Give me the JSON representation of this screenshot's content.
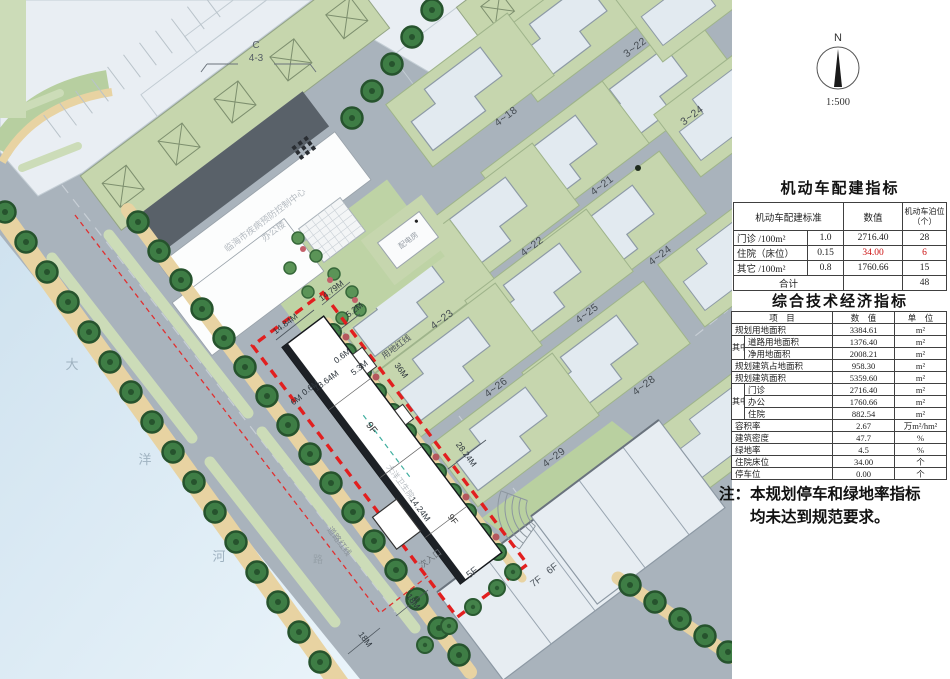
{
  "compass": {
    "north": "N",
    "scale": "1:500"
  },
  "map": {
    "labels": {
      "top_left_lot_l1": "C",
      "top_left_lot_l2": "4-3",
      "cdc_l1": "临海市疾病预防控制中心",
      "cdc_l2": "办公楼",
      "power_room": "配电房",
      "hospital_name": "大洋卫生院",
      "land_red_line": "用地红线",
      "road_red_line": "道路红线",
      "secondary_entrance": "次入口",
      "floors_9f": "9F",
      "floors_5f": "5F",
      "floors_7f": "7F",
      "floors_6f": "6F",
      "river_c1": "大",
      "river_c2": "洋",
      "river_c3": "河",
      "road_char": "路"
    },
    "lots": {
      "l3_22": "3~22",
      "l3_24": "3~24",
      "l4_18": "4~18",
      "l4_21": "4~21",
      "l4_22": "4~22",
      "l4_23": "4~23",
      "l4_24": "4~24",
      "l4_25": "4~25",
      "l4_26": "4~26",
      "l4_28": "4~28",
      "l4_29": "4~29"
    },
    "dims": {
      "d1": "14.84M",
      "d2": "14.79M",
      "d3": "5.2M",
      "d4": "0.6M",
      "d5": "5.3M",
      "d6": "36M",
      "d7": "13.64M",
      "d8": "0.6M",
      "d9": "6M",
      "d10": "28.24M",
      "d11": "14.24M",
      "d12": "18M",
      "d13": "18M"
    }
  },
  "tables": {
    "parking": {
      "title": "机动车配建指标",
      "head": {
        "standard": "机动车配建标准",
        "value": "数值",
        "berth_l1": "机动车泊位",
        "berth_l2": "（个）"
      },
      "rows": [
        {
          "name": "门诊 /100m²",
          "std": "1.0",
          "value": "2716.40",
          "berth": "28"
        },
        {
          "name": "住院（床位）",
          "std": "0.15",
          "value": "34.00",
          "berth": "6"
        },
        {
          "name": "其它 /100m²",
          "std": "0.8",
          "value": "1760.66",
          "berth": "15"
        },
        {
          "name": "合计",
          "std": "",
          "value": "",
          "berth": "48"
        }
      ]
    },
    "economic": {
      "title": "综合技术经济指标",
      "head": {
        "item": "项　目",
        "value": "数　值",
        "unit": "单　位"
      },
      "group_label": "其中",
      "rows": [
        {
          "item": "规划用地面积",
          "value": "3384.61",
          "unit": "m²"
        },
        {
          "item": "道路用地面积",
          "value": "1376.40",
          "unit": "m²"
        },
        {
          "item": "净用地面积",
          "value": "2008.21",
          "unit": "m²"
        },
        {
          "item": "规划建筑占地面积",
          "value": "958.30",
          "unit": "m²"
        },
        {
          "item": "规划建筑面积",
          "value": "5359.60",
          "unit": "m²"
        },
        {
          "item": "门诊",
          "value": "2716.40",
          "unit": "m²"
        },
        {
          "item": "办公",
          "value": "1760.66",
          "unit": "m²"
        },
        {
          "item": "住院",
          "value": "882.54",
          "unit": "m²"
        },
        {
          "item": "容积率",
          "value": "2.67",
          "unit": "万m²/hm²"
        },
        {
          "item": "建筑密度",
          "value": "47.7",
          "unit": "%"
        },
        {
          "item": "绿地率",
          "value": "4.5",
          "unit": "%"
        },
        {
          "item": "住院床位",
          "value": "34.00",
          "unit": "个"
        },
        {
          "item": "停车位",
          "value": "0.00",
          "unit": "个"
        }
      ]
    }
  },
  "note": {
    "prefix": "注：",
    "line1": "本规划停车和绿地率指标",
    "line2": "均未达到规范要求。"
  }
}
